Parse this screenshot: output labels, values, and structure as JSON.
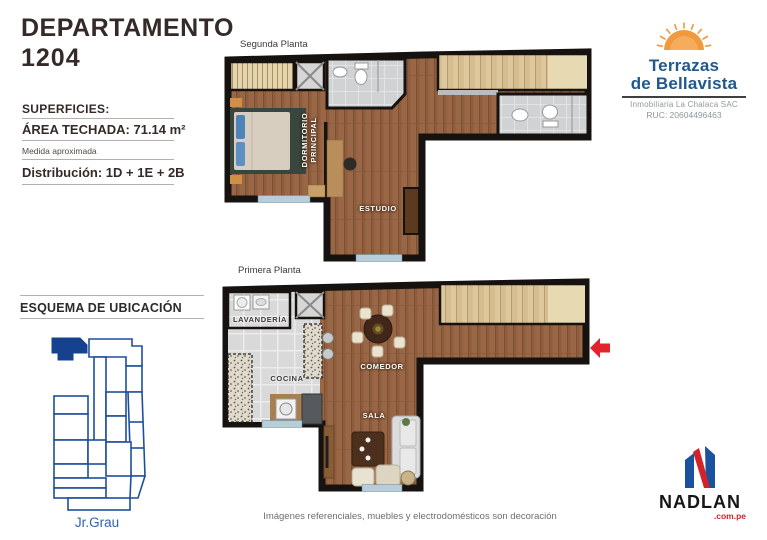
{
  "page": {
    "title_line1": "DEPARTAMENTO",
    "title_line2": "1204",
    "footer_note": "Imágenes referenciales, muebles y electrodomésticos son decoración"
  },
  "specs": {
    "superficies_label": "SUPERFICIES:",
    "area_label": "ÁREA TECHADA:",
    "area_value": "71.14 m²",
    "measure_note": "Medida aproximada",
    "distribution_label": "Distribución:",
    "distribution_value": "1D + 1E + 2B"
  },
  "location": {
    "title": "ESQUEMA DE UBICACIÓN",
    "street": "Jr.Grau"
  },
  "plans": {
    "second": {
      "label": "Segunda Planta",
      "rooms": {
        "dormitorio_line1": "DORMITORIO",
        "dormitorio_line2": "PRINCIPAL",
        "estudio": "ESTUDIO"
      }
    },
    "first": {
      "label": "Primera Planta",
      "rooms": {
        "lavanderia": "LAVANDERÍA",
        "cocina": "COCINA",
        "comedor": "COMEDOR",
        "sala": "SALA"
      }
    }
  },
  "brand": {
    "terrazas": {
      "name_line1": "Terrazas",
      "name_line2": "de Bellavista",
      "subtitle": "Inmobiliaria La Chalaca SAC",
      "ruc": "RUC: 20604496463"
    },
    "nadlan": {
      "name": "NADLAN",
      "domain": ".com.pe"
    }
  },
  "colors": {
    "brand_blue": "#20598e",
    "sun_orange": "#f0993d",
    "diagram_blue": "#1e4f9c",
    "highlight_unit_blue": "#15418f",
    "nadlan_blue": "#1a52a0",
    "nadlan_red": "#d2232a",
    "arrow_red": "#e2232e",
    "wall_black": "#151210",
    "wood_floor": "#9a6746",
    "stair_wood": "#ddc79d"
  }
}
